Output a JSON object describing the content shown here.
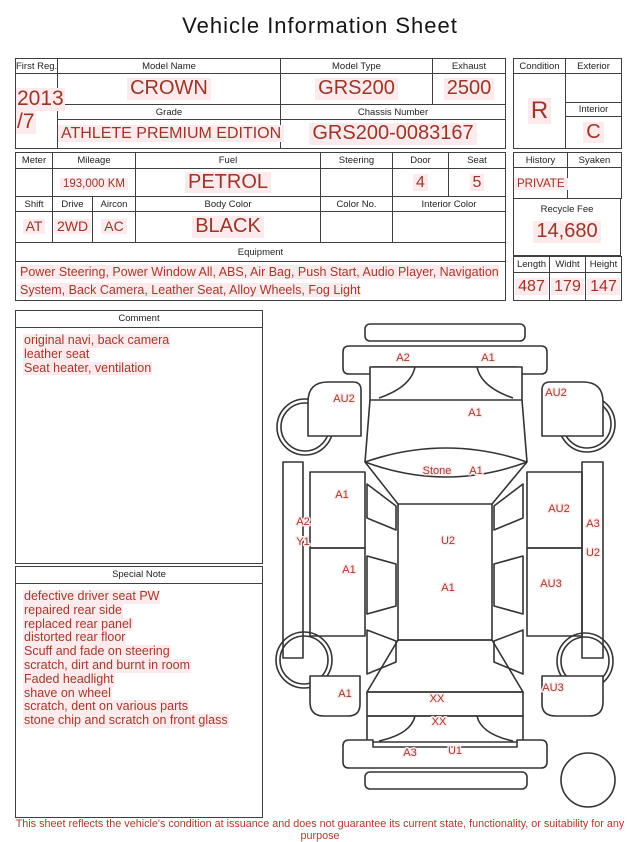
{
  "title": "Vehicle Information Sheet",
  "colors": {
    "accent_red": "#993627",
    "highlight_pink": "#fdeaed",
    "border": "#3f3f3f"
  },
  "table1": {
    "first_reg_label": "First Reg.",
    "first_reg_line1": "2013",
    "first_reg_line2": "/7",
    "model_name_label": "Model Name",
    "model_name": "CROWN",
    "model_type_label": "Model Type",
    "model_type": "GRS200",
    "exhaust_label": "Exhaust",
    "exhaust": "2500",
    "grade_label": "Grade",
    "grade": "ATHLETE PREMIUM EDITION",
    "chassis_label": "Chassis Number",
    "chassis": "GRS200-0083167",
    "condition_label": "Condition",
    "condition": "R",
    "exterior_label": "Exterior",
    "exterior": "",
    "interior_label": "Interior",
    "interior": "C"
  },
  "table2": {
    "meter_label": "Meter",
    "meter": "",
    "mileage_label": "Mileage",
    "mileage": "193,000 KM",
    "fuel_label": "Fuel",
    "fuel": "PETROL",
    "steering_label": "Steering",
    "steering": "",
    "door_label": "Door",
    "door": "4",
    "seat_label": "Seat",
    "seat": "5",
    "history_label": "History",
    "history": "PRIVATE",
    "syaken_label": "Syaken",
    "syaken": ""
  },
  "table3": {
    "shift_label": "Shift",
    "shift": "AT",
    "drive_label": "Drive",
    "drive": "2WD",
    "aircon_label": "Aircon",
    "aircon": "AC",
    "body_color_label": "Body Color",
    "body_color": "BLACK",
    "color_no_label": "Color No.",
    "color_no": "",
    "interior_color_label": "Interior Color",
    "interior_color": ""
  },
  "equipment": {
    "label": "Equipment",
    "text": "Power Steering, Power Window  All, ABS, Air Bag, Push Start, Audio Player, Navigation System, Back Camera, Leather Seat, Alloy Wheels, Fog Light"
  },
  "fees": {
    "recycle_label": "Recycle Fee",
    "recycle": "14,680"
  },
  "dimensions": {
    "length_label": "Length",
    "length": "487",
    "width_label": "Widht",
    "width": "179",
    "height_label": "Height",
    "height": "147"
  },
  "comment": {
    "label": "Comment",
    "lines": [
      "original navi, back camera",
      "leather seat",
      "Seat heater, ventilation"
    ]
  },
  "special_note": {
    "label": "Special Note",
    "lines": [
      "defective driver seat PW",
      "repaired rear side",
      "replaced rear panel",
      "distorted rear floor",
      "Scuff and fade on steering",
      "scratch, dirt and burnt in room",
      "Faded headlight",
      "shave on wheel",
      "scratch, dent on various parts",
      "stone chip and scratch on front glass"
    ]
  },
  "diagram": {
    "labels": [
      {
        "text": "A2",
        "x": 138,
        "y": 51
      },
      {
        "text": "A1",
        "x": 223,
        "y": 51
      },
      {
        "text": "AU2",
        "x": 79,
        "y": 92
      },
      {
        "text": "AU2",
        "x": 291,
        "y": 86
      },
      {
        "text": "A1",
        "x": 210,
        "y": 106
      },
      {
        "text": "Stone",
        "x": 172,
        "y": 164
      },
      {
        "text": "A1",
        "x": 211,
        "y": 164
      },
      {
        "text": "A1",
        "x": 77,
        "y": 188
      },
      {
        "text": "A2",
        "x": 38,
        "y": 215
      },
      {
        "text": "Y1",
        "x": 38,
        "y": 235
      },
      {
        "text": "AU2",
        "x": 294,
        "y": 202
      },
      {
        "text": "A3",
        "x": 328,
        "y": 217
      },
      {
        "text": "U2",
        "x": 183,
        "y": 234
      },
      {
        "text": "U2",
        "x": 328,
        "y": 246
      },
      {
        "text": "A1",
        "x": 84,
        "y": 263
      },
      {
        "text": "AU3",
        "x": 286,
        "y": 277
      },
      {
        "text": "A1",
        "x": 183,
        "y": 281
      },
      {
        "text": "A1",
        "x": 80,
        "y": 387
      },
      {
        "text": "AU3",
        "x": 288,
        "y": 381
      },
      {
        "text": "XX",
        "x": 172,
        "y": 392
      },
      {
        "text": "XX",
        "x": 174,
        "y": 415
      },
      {
        "text": "A3",
        "x": 145,
        "y": 446
      },
      {
        "text": "U1",
        "x": 190,
        "y": 444
      }
    ]
  },
  "footer": "This sheet reflects the vehicle's condition at issuance and does not guarantee its current state, functionality, or suitability for any purpose"
}
